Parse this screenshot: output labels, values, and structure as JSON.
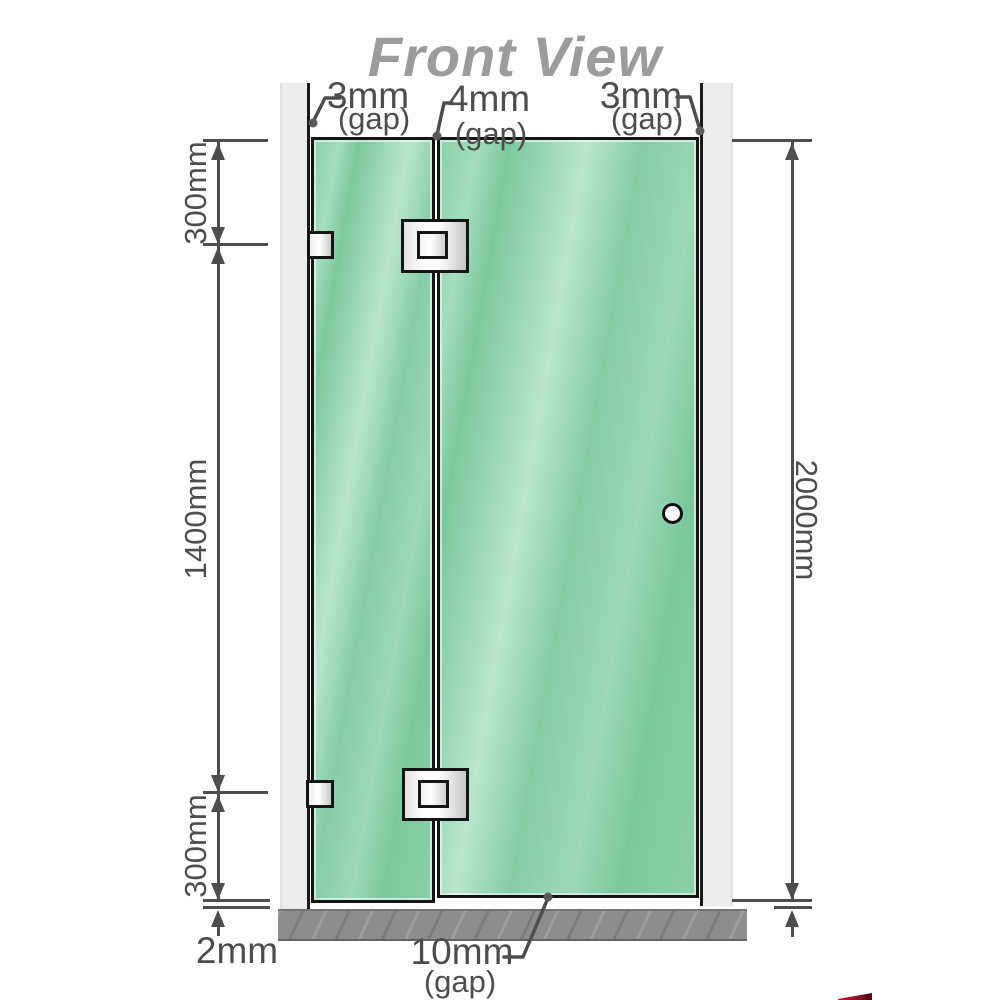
{
  "title": "Front View",
  "colors": {
    "line": "#4d4d4d",
    "title": "#9c9c9c",
    "glass": "#7ec9a0",
    "glass-light": "#b9e6cc",
    "glass-border": "#151515",
    "wall": "#ededed",
    "wall-edge": "#1a1a1a",
    "floor": "#8d8d8d",
    "metal-light": "#ffffff",
    "metal-dark": "#c6c6c6",
    "logo-red": "#8e1328"
  },
  "gap_labels": {
    "top_left": {
      "value": "3mm",
      "note": "(gap)"
    },
    "top_middle": {
      "value": "4mm",
      "note": "(gap)"
    },
    "top_right": {
      "value": "3mm",
      "note": "(gap)"
    },
    "bottom": {
      "value": "10mm",
      "note": "(gap)"
    }
  },
  "dimensions": {
    "left_top": "300mm",
    "left_middle": "1400mm",
    "left_bottom": "300mm",
    "left_floor": "2mm",
    "right_full": "2000mm"
  }
}
